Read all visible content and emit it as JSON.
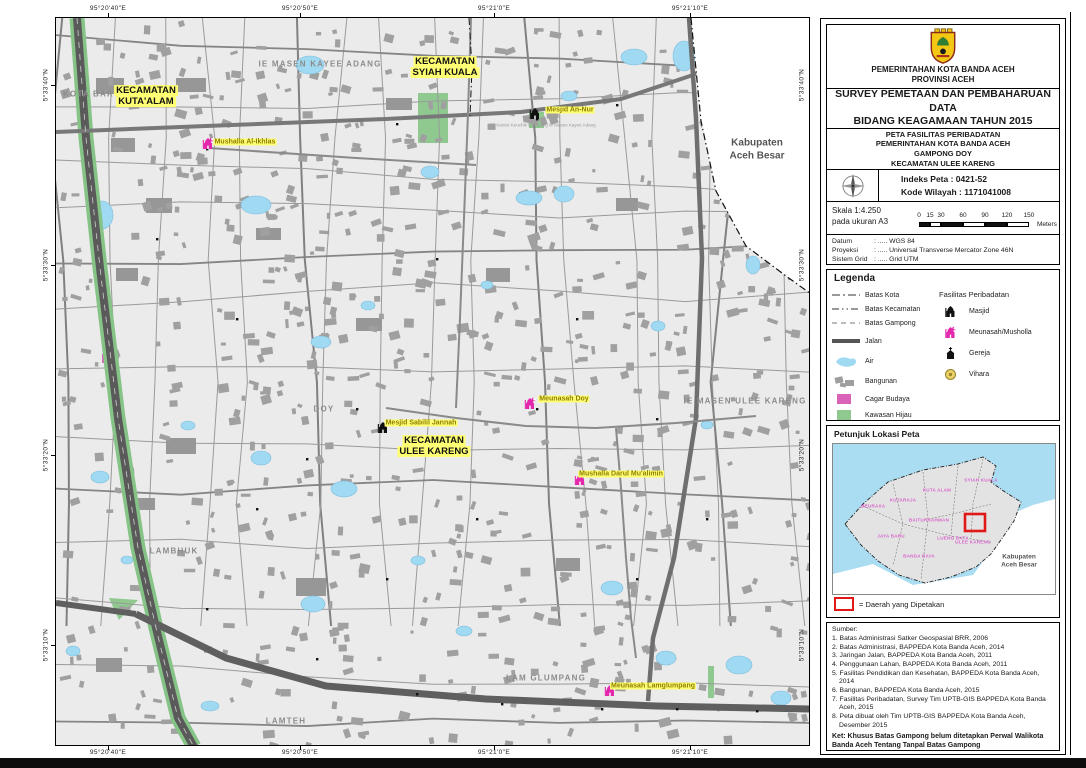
{
  "map": {
    "coords": {
      "top": [
        {
          "text": "95°20'40\"E",
          "x": 108
        },
        {
          "text": "95°20'50\"E",
          "x": 300
        },
        {
          "text": "95°21'0\"E",
          "x": 494
        },
        {
          "text": "95°21'10\"E",
          "x": 690
        }
      ],
      "bottom": [
        {
          "text": "95°20'40\"E",
          "x": 108
        },
        {
          "text": "95°20'50\"E",
          "x": 300
        },
        {
          "text": "95°21'0\"E",
          "x": 494
        },
        {
          "text": "95°21'10\"E",
          "x": 690
        }
      ],
      "left": [
        {
          "text": "5°33'40\"N",
          "y": 85
        },
        {
          "text": "5°33'30\"N",
          "y": 265
        },
        {
          "text": "5°33'20\"N",
          "y": 455
        },
        {
          "text": "5°33'10\"N",
          "y": 645
        }
      ],
      "right": [
        {
          "text": "5°33'40\"N",
          "y": 85
        },
        {
          "text": "5°33'30\"N",
          "y": 265
        },
        {
          "text": "5°33'20\"N",
          "y": 455
        },
        {
          "text": "5°33'10\"N",
          "y": 645
        }
      ]
    },
    "area_labels": [
      {
        "text": "KOTA BARU",
        "x": 92,
        "y": 94
      },
      {
        "text": "IE MASEN KAYEE ADANG",
        "x": 320,
        "y": 64
      },
      {
        "text": "DOY",
        "x": 324,
        "y": 409
      },
      {
        "text": "IE MASEN ULEE KARENG",
        "x": 745,
        "y": 401
      },
      {
        "text": "LAMBHUK",
        "x": 174,
        "y": 551
      },
      {
        "text": "LAM GLUMPANG",
        "x": 546,
        "y": 678
      },
      {
        "text": "LAMTEH",
        "x": 286,
        "y": 721
      }
    ],
    "kecamatan_labels": [
      {
        "line1": "KECAMATAN",
        "line2": "KUTA'ALAM",
        "x": 146,
        "y": 97
      },
      {
        "line1": "KECAMATAN",
        "line2": "SYIAH KUALA",
        "x": 445,
        "y": 68
      },
      {
        "line1": "KECAMATAN",
        "line2": "ULEE KARENG",
        "x": 434,
        "y": 447
      }
    ],
    "poi_labels": [
      {
        "name": "Mushalla Al-Ikhlas",
        "icon": "meunasah",
        "ix": 208,
        "iy": 146,
        "lx": 245,
        "ly": 142
      },
      {
        "name": "Mesjid An-Nur",
        "icon": "masjid",
        "ix": 535,
        "iy": 116,
        "lx": 570,
        "ly": 110
      },
      {
        "name": "Meunasah Doy",
        "icon": "meunasah",
        "ix": 530,
        "iy": 406,
        "lx": 564,
        "ly": 399
      },
      {
        "name": "Mesjid Sabilil Jannah",
        "icon": "masjid",
        "ix": 383,
        "iy": 430,
        "lx": 421,
        "ly": 423
      },
      {
        "name": "Mushalla Darul Mu'alimin",
        "icon": "meunasah",
        "ix": 580,
        "iy": 482,
        "lx": 621,
        "ly": 474
      },
      {
        "name": "Meunasah Lamglumpang",
        "icon": "meunasah",
        "ix": 610,
        "iy": 693,
        "lx": 653,
        "ly": 686
      }
    ],
    "tiny_labels": [
      {
        "text": "Kantor Keuchik Gampong Ie Masen Kayee Adang",
        "x": 546,
        "y": 125
      }
    ],
    "outside_label": {
      "line1": "Kabupaten",
      "line2": "Aceh Besar",
      "x": 757,
      "y": 150
    }
  },
  "panel": {
    "header": {
      "org_line1": "PEMERINTAHAN KOTA BANDA ACEH",
      "org_line2": "PROVINSI ACEH"
    },
    "title": {
      "line1": "SURVEY PEMETAAN DAN PEMBAHARUAN DATA",
      "line2": "BIDANG KEAGAMAAN TAHUN 2015"
    },
    "subtitle": {
      "lines": [
        "PETA FASILITAS PERIBADATAN",
        "PEMERINTAHAN KOTA BANDA ACEH",
        "GAMPONG DOY",
        "KECAMATAN ULEE KARENG"
      ]
    },
    "index": {
      "indeks": "Indeks Peta   : 0421-52",
      "kode": "Kode Wilayah : 1171041008"
    },
    "scale": {
      "line1": "Skala 1:4.250",
      "line2": "pada ukuran A3",
      "ticks": [
        {
          "label": "0",
          "m": 0
        },
        {
          "label": "15",
          "m": 15
        },
        {
          "label": "30",
          "m": 30
        },
        {
          "label": "60",
          "m": 60
        },
        {
          "label": "90",
          "m": 90
        },
        {
          "label": "120",
          "m": 120
        },
        {
          "label": "150",
          "m": 150
        }
      ],
      "unit": "Meters"
    },
    "datum_rows": [
      {
        "label": "Datum",
        "value": ": ..... WGS 84"
      },
      {
        "label": "Proyeksi",
        "value": ": ..... Universal Transverse Mercator Zone 46N"
      },
      {
        "label": "Sistem Grid",
        "value": ": ..... Grid UTM"
      }
    ],
    "legend": {
      "title": "Legenda",
      "line_items": [
        {
          "label": "Batas Kota",
          "dash": "8 3 2 3"
        },
        {
          "label": "Batas Kecamatan",
          "dash": "7 3 1.5 3 1.5 3"
        },
        {
          "label": "Batas Gampong",
          "dash": "5 4"
        }
      ],
      "jalan_label": "Jalan",
      "area_items": [
        {
          "label": "Air",
          "type": "air"
        },
        {
          "label": "Bangunan",
          "type": "bangunan"
        },
        {
          "label": "Cagar Budaya",
          "type": "cagar"
        },
        {
          "label": "Kawasan Hijau",
          "type": "hijau"
        }
      ],
      "fasilitas_title": "Fasilitas Peribadatan",
      "fasilitas_items": [
        {
          "label": "Masjid",
          "icon": "masjid"
        },
        {
          "label": "Meunasah/Musholla",
          "icon": "meunasah"
        },
        {
          "label": "Gereja",
          "icon": "gereja"
        },
        {
          "label": "Vihara",
          "icon": "vihara"
        }
      ]
    },
    "inset": {
      "title": "Petunjuk Lokasi Peta",
      "districts": [
        {
          "name": "SYIAH KUALA",
          "x": 148,
          "y": 36
        },
        {
          "name": "KUTA ALAM",
          "x": 104,
          "y": 46
        },
        {
          "name": "KUTARAJA",
          "x": 70,
          "y": 56
        },
        {
          "name": "MEURAXA",
          "x": 40,
          "y": 62
        },
        {
          "name": "BAITURRAHMAN",
          "x": 96,
          "y": 76
        },
        {
          "name": "LUENG BATA",
          "x": 120,
          "y": 94
        },
        {
          "name": "JAYA BARU",
          "x": 58,
          "y": 92
        },
        {
          "name": "BANDA RAYA",
          "x": 86,
          "y": 112
        },
        {
          "name": "ULEE KARENG",
          "x": 140,
          "y": 98
        }
      ],
      "outside_line1": "Kabupaten",
      "outside_line2": "Aceh Besar",
      "note": "= Daerah yang Dipetakan"
    },
    "sumber": {
      "title": "Sumber:",
      "items": [
        "1. Batas Administrasi Satker Geospasial BRR, 2006",
        "2. Batas Administrasi, BAPPEDA Kota Banda Aceh, 2014",
        "3. Jaringan Jalan, BAPPEDA Kota Banda Aceh, 2011",
        "4. Penggunaan Lahan, BAPPEDA Kota Banda Aceh, 2011",
        "5. Fasilitas Pendidikan dan Kesehatan, BAPPEDA Kota Banda Aceh, 2014",
        "6. Bangunan, BAPPEDA Kota Banda Aceh, 2015",
        "7. Fasilitas Peribadatan, Survey Tim UPTB-GIS BAPPEDA Kota Banda Aceh, 2015",
        "8. Peta dibuat oleh Tim UPTB-GIS BAPPEDA Kota Banda Aceh, Desember 2015"
      ],
      "ket_line1": "Ket: Khusus Batas Gampong belum ditetapkan Perwal Walikota",
      "ket_line2": "Banda Aceh Tentang Tanpal Batas Gampong"
    }
  },
  "colors": {
    "land": "#ebebeb",
    "building": "#a0a0a0",
    "water": "#9fd9f2",
    "green": "#8fc98f",
    "highway_green": "#86c386",
    "road_major": "#5f5f5f",
    "road_minor": "#9a9a9a",
    "magenta": "#e328ad",
    "cagar": "#d863b8",
    "label_bg": "#ffff73",
    "poi_text": "#8f7f00",
    "area_text": "#8c8c8c",
    "accent_red": "#e01818",
    "inset_sea": "#aadcf2",
    "district_text": "#d966cc"
  }
}
